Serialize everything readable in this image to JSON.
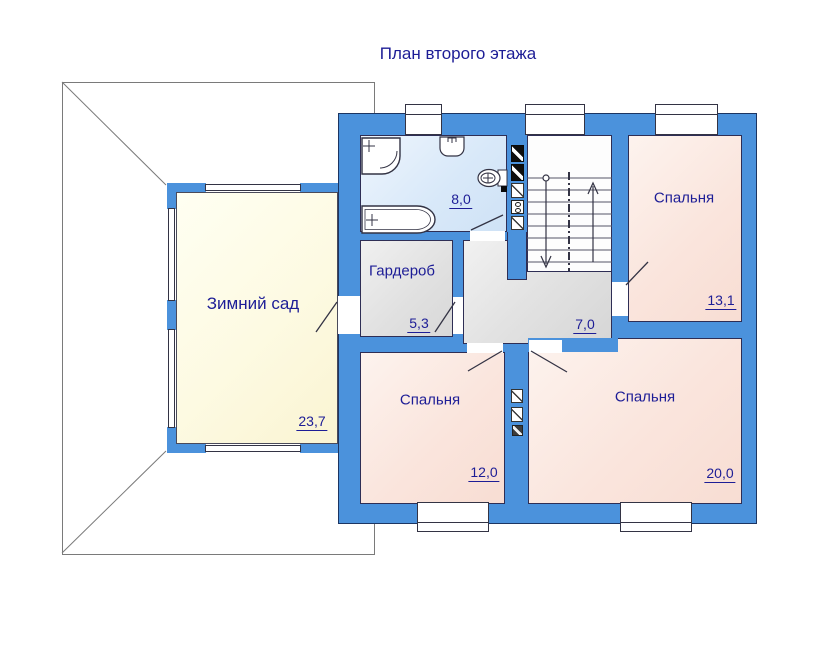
{
  "page": {
    "title": "План второго этажа"
  },
  "rooms": [
    {
      "id": "winter-garden",
      "label": "Зимний сад",
      "area": "23,7"
    },
    {
      "id": "bathroom",
      "label": "",
      "area": "8,0"
    },
    {
      "id": "wardrobe",
      "label": "Гардероб",
      "area": "5,3"
    },
    {
      "id": "hall",
      "label": "",
      "area": "7,0"
    },
    {
      "id": "bedroom-top-right",
      "label": "Спальня",
      "area": "13,1"
    },
    {
      "id": "bedroom-bottom-left",
      "label": "Спальня",
      "area": "12,0"
    },
    {
      "id": "bedroom-bottom-right",
      "label": "Спальня",
      "area": "20,0"
    }
  ],
  "icons": [
    "shower-icon",
    "sink-icon",
    "toilet-icon",
    "bathtub-icon",
    "stairs-up-arrow-icon",
    "stairs-down-arrow-icon",
    "vent-shaft-icon",
    "window-icon",
    "door-leaf-icon",
    "roof-outline"
  ],
  "colors": {
    "wall_blue": "#4b92dc",
    "text_navy": "#1d1d96",
    "bedroom_fill": "#fae5dd",
    "winter_garden_fill": "#fdfae2",
    "bathroom_fill": "#d9e9f9",
    "hall_fill": "#e2e2e2",
    "roof_line": "#7a7a7a"
  }
}
